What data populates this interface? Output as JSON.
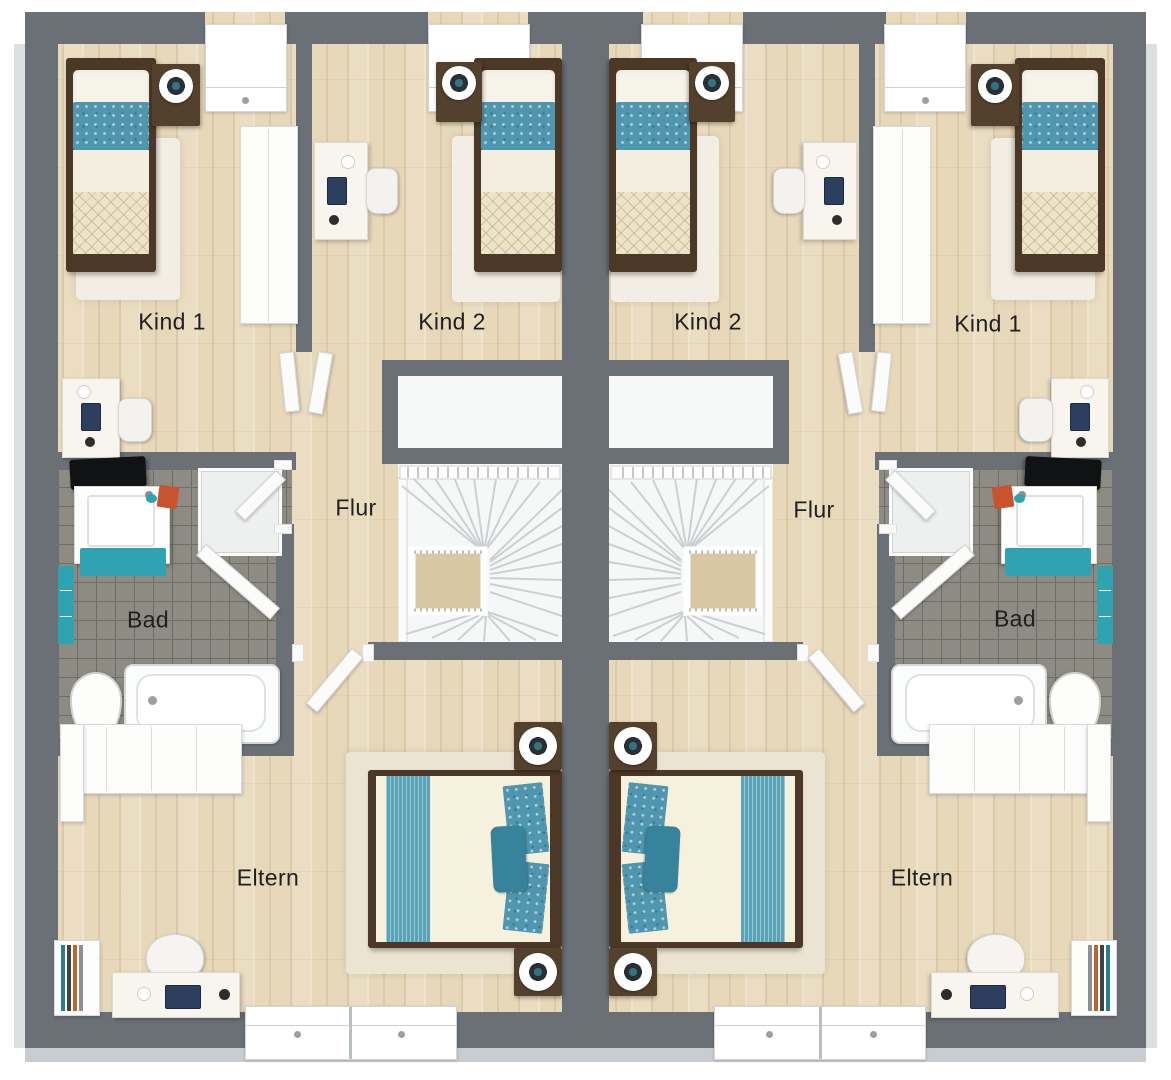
{
  "rooms": {
    "left": {
      "kind1": "Kind 1",
      "kind2": "Kind 2",
      "flur": "Flur",
      "bad": "Bad",
      "eltern": "Eltern"
    },
    "right": {
      "kind2": "Kind 2",
      "kind1": "Kind 1",
      "flur": "Flur",
      "bad": "Bad",
      "eltern": "Eltern"
    }
  },
  "colors": {
    "wall_gray": "#6b7077",
    "wood_floor": "#e7d8ba",
    "bath_tile": "#8d8b83",
    "teal_accent": "#2fa3b2",
    "bed_blue_pattern": "#4f96ae",
    "quilt_cream": "#ece3c9",
    "bed_frame_brown": "#4c3827",
    "label_text": "#1f1f1f"
  }
}
